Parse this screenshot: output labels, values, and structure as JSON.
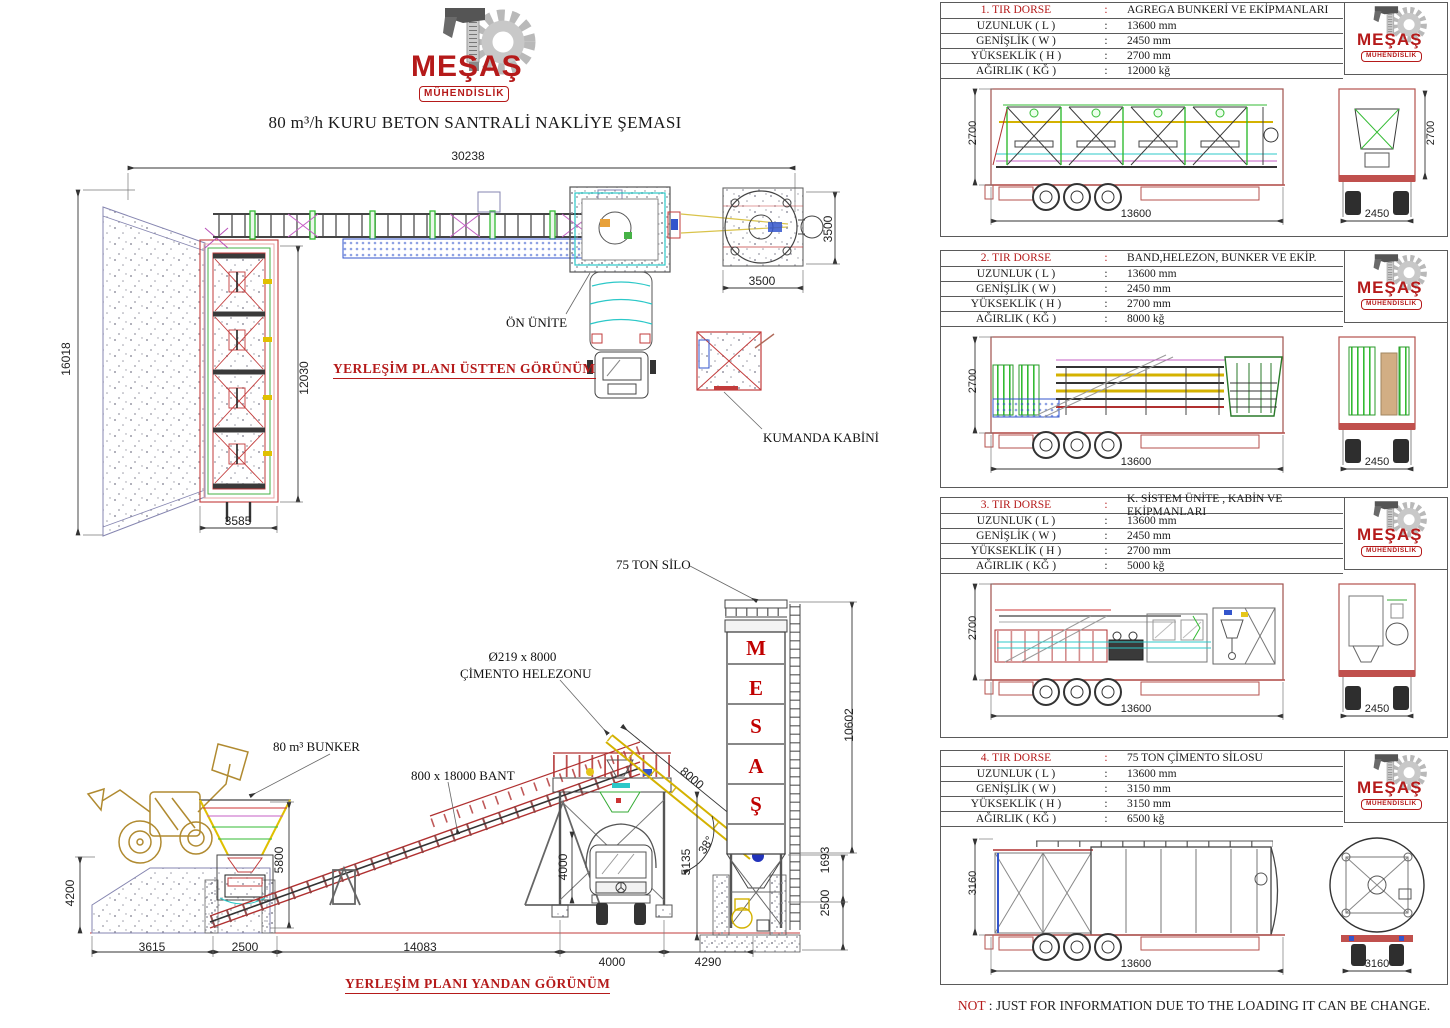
{
  "logo": {
    "brand": "MEŞAŞ",
    "subtitle": "MÜHENDİSLİK"
  },
  "title": "80 m³/h KURU BETON SANTRALİ NAKLİYE ŞEMASI",
  "punct": {
    "colon": ":"
  },
  "plan_top": {
    "caption": "YERLEŞİM PLANI ÜSTTEN GÖRÜNÜM",
    "label_on_unite": "ÖN ÜNİTE",
    "label_kumanda": "KUMANDA KABİNİ",
    "dims": {
      "total_len": "30238",
      "site_width": "16018",
      "bunker_len": "12030",
      "bunker_w": "3585",
      "pad_w": "3500",
      "pad_h": "3500"
    }
  },
  "plan_side": {
    "caption": "YERLEŞİM PLANI YANDAN GÖRÜNÜM",
    "label_bunker": "80 m³ BUNKER",
    "label_belt": "800 x 18000 BANT",
    "label_screw_line1": "Ø219 x 8000",
    "label_screw_line2": "ÇİMENTO HELEZONU",
    "label_silo": "75 TON SİLO",
    "silo_letters": [
      "M",
      "E",
      "S",
      "A",
      "Ş"
    ],
    "dims": {
      "ramp_h": "4200",
      "bunker_h": "5800",
      "ramp_len": "3615",
      "pit_len": "2500",
      "belt_len": "14083",
      "mixer_h": "4000",
      "mixer_w": "4000",
      "plant_h": "5135",
      "silo_gap": "4290",
      "screw_len": "8000",
      "screw_angle": "38°",
      "silo_h": "10602",
      "silo_leg": "1693",
      "pit_depth": "2500"
    }
  },
  "panels": [
    {
      "no": "1. TIR DORSE",
      "desc": "AGREGA BUNKERİ VE EKİPMANLARI",
      "specs": [
        {
          "label": "UZUNLUK ( L )",
          "value": "13600 mm"
        },
        {
          "label": "GENİŞLİK ( W )",
          "value": "2450 mm"
        },
        {
          "label": "YÜKSEKLİK ( H )",
          "value": "2700 mm"
        },
        {
          "label": "AĞIRLIK ( KĞ )",
          "value": "12000 kğ"
        }
      ],
      "dims": {
        "side_h": "2700",
        "side_l": "13600",
        "rear_h": "2700",
        "rear_w": "2450"
      }
    },
    {
      "no": "2. TIR DORSE",
      "desc": "BAND,HELEZON, BUNKER VE EKİP.",
      "specs": [
        {
          "label": "UZUNLUK ( L )",
          "value": "13600 mm"
        },
        {
          "label": "GENİŞLİK ( W )",
          "value": "2450 mm"
        },
        {
          "label": "YÜKSEKLİK ( H )",
          "value": "2700 mm"
        },
        {
          "label": "AĞIRLIK ( KĞ )",
          "value": "8000 kğ"
        }
      ],
      "dims": {
        "side_h": "2700",
        "side_l": "13600",
        "rear_w": "2450"
      }
    },
    {
      "no": "3. TIR DORSE",
      "desc": "K. SİSTEM ÜNİTE , KABİN VE EKİPMANLARI",
      "specs": [
        {
          "label": "UZUNLUK ( L )",
          "value": "13600 mm"
        },
        {
          "label": "GENİŞLİK ( W )",
          "value": "2450 mm"
        },
        {
          "label": "YÜKSEKLİK ( H )",
          "value": "2700 mm"
        },
        {
          "label": "AĞIRLIK ( KĞ )",
          "value": "5000 kğ"
        }
      ],
      "dims": {
        "side_h": "2700",
        "side_l": "13600",
        "rear_w": "2450"
      }
    },
    {
      "no": "4. TIR DORSE",
      "desc": "75 TON ÇİMENTO SİLOSU",
      "specs": [
        {
          "label": "UZUNLUK ( L )",
          "value": "13600 mm"
        },
        {
          "label": "GENİŞLİK ( W )",
          "value": "3150 mm"
        },
        {
          "label": "YÜKSEKLİK ( H )",
          "value": "3150 mm"
        },
        {
          "label": "AĞIRLIK ( KĞ )",
          "value": "6500 kğ"
        }
      ],
      "dims": {
        "side_h": "3160",
        "side_l": "13600",
        "rear_w": "3160"
      }
    }
  ],
  "note": {
    "prefix": "NOT",
    "text": ": JUST FOR INFORMATION DUE TO THE LOADING IT CAN BE CHANGE."
  }
}
